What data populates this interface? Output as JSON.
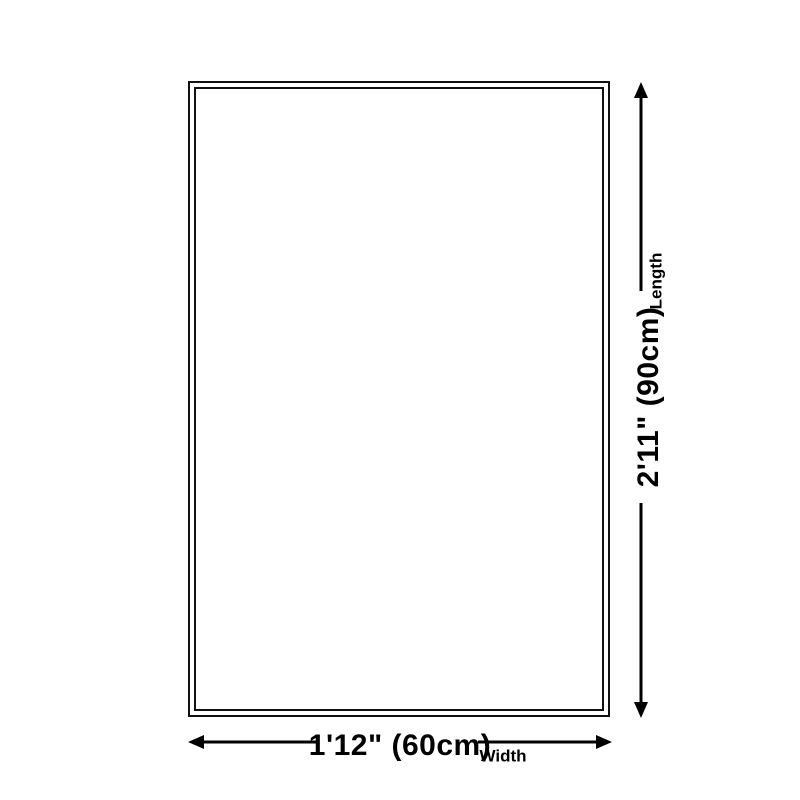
{
  "diagram": {
    "type": "product-dimension-diagram",
    "shape": "rectangle-outline-double-border",
    "width": {
      "dimension": "1'12\" (60cm)",
      "label": "Width"
    },
    "length": {
      "dimension": "2'11\" (90cm)",
      "label": "Length"
    },
    "colors": {
      "background": "#ffffff",
      "outline": "#111111",
      "arrow": "#000000",
      "text": "#000000"
    }
  }
}
